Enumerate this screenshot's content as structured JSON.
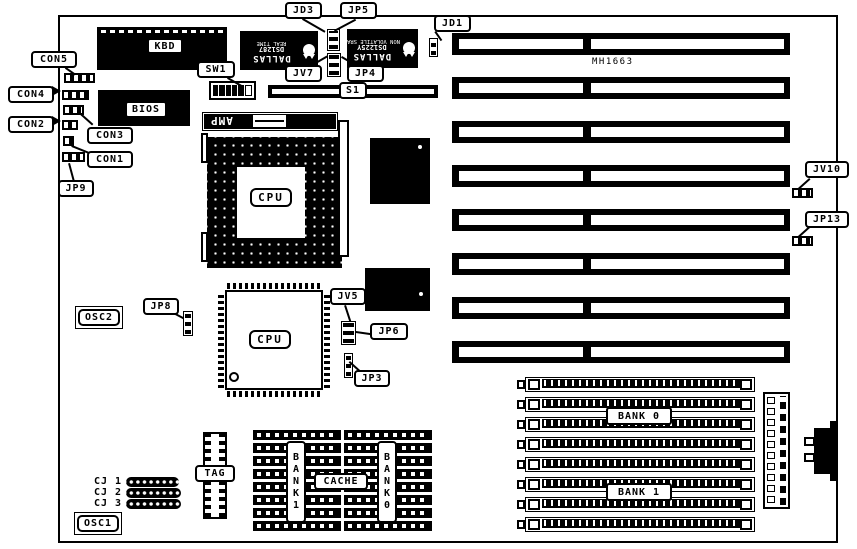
{
  "diagram": {
    "board_name": "MH1663",
    "isa_slot_count": 8,
    "simm_socket_count": 8,
    "cache_row_count": 8
  },
  "labels": {
    "con5": "CON5",
    "con4": "CON4",
    "con3": "CON3",
    "con2": "CON2",
    "con1": "CON1",
    "jp9": "JP9",
    "sw1": "SW1",
    "jd3": "JD3",
    "jp5": "JP5",
    "jv7": "JV7",
    "jp4": "JP4",
    "jd1": "JD1",
    "s1": "S1",
    "mh1663": "MH1663",
    "jv10": "JV10",
    "jp13": "JP13",
    "osc2": "OSC2",
    "jp8": "JP8",
    "jv5": "JV5",
    "jp6": "JP6",
    "jp3": "JP3",
    "kbd": "KBD",
    "bios": "BIOS",
    "amp": "AMP",
    "cpu1": "CPU",
    "cpu2": "CPU",
    "tag": "TAG",
    "cache": "CACHE",
    "bank1_cache": "BANK1",
    "bank0_cache": "BANK0",
    "bank0_simm": "BANK 0",
    "bank1_simm": "BANK 1",
    "osc1": "OSC1",
    "cj1": "CJ 1",
    "cj2": "CJ 2",
    "cj3": "CJ 3"
  },
  "chips": {
    "dallas1": {
      "brand": "DALLAS",
      "part": "DS1287",
      "desc": "REAL TIME"
    },
    "dallas2": {
      "brand": "DALLAS",
      "part": "DS1225Y",
      "desc": "NON VOLATILE SRAM"
    }
  },
  "colors": {
    "ink": "#000000",
    "paper": "#ffffff"
  }
}
